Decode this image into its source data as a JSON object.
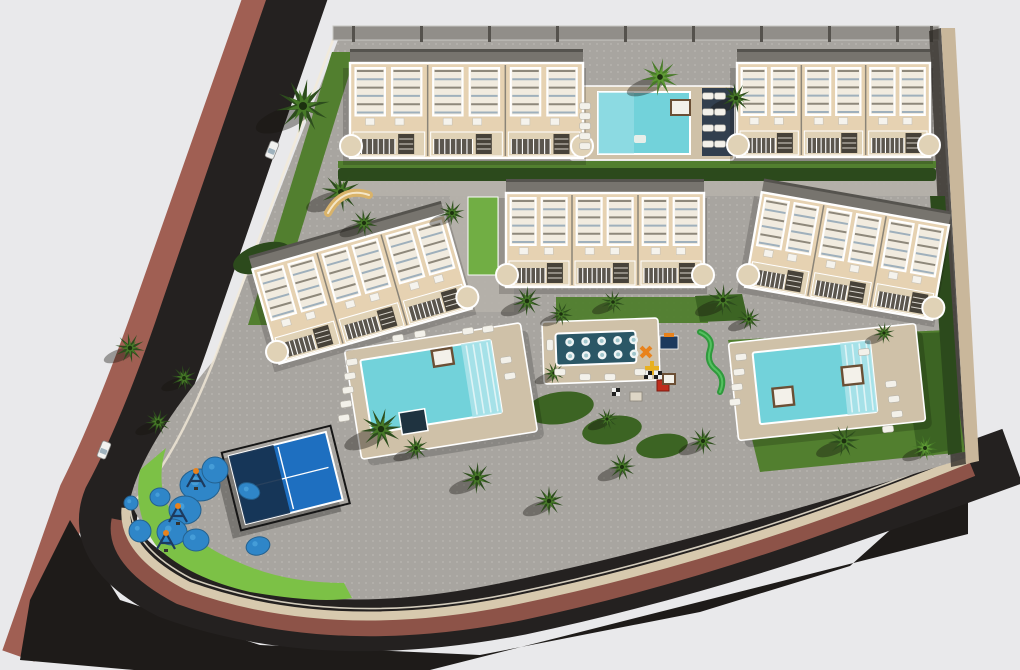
{
  "meta": {
    "description": "3D aerial architectural render of a coastal residential complex: five beige townhouse blocks with white rooftop pergolas, three turquoise swimming pools, a dark jet-spa platform, padel court, two playgrounds, palm trees and a curving asphalt road with terracotta sidewalks",
    "canvas_w": 1020,
    "canvas_h": 670
  },
  "palette": {
    "bg": "#e9e9eb",
    "road": "#242120",
    "shadow": "#1e1b19",
    "walk_outer": "#a05f53",
    "walk_inner": "#8d5348",
    "curb": "#d7c9ae",
    "curbline": "#f2ead8",
    "parcel": "#a8a5a0",
    "parcel_dot": "#c7c4be",
    "walk_light": "#b5b1aa",
    "wall_top": "#918e89",
    "wall_post": "#55524d",
    "wall_right": "#c9b79b",
    "wall_right_shadow": "#2f2b26",
    "grass_mid": "#527f2f",
    "grass_dark": "#3c6423",
    "grass_bright": "#6fae41",
    "crescent": "#7cc146",
    "hedge": "#2c4a1c",
    "palm_dark": "#2d4d1d",
    "palm_mid": "#477a28",
    "palm_light": "#5f9a35",
    "deck": "#cfc1a8",
    "pool": "#72d2da",
    "pool_light": "#aee4ea",
    "pool_step": "#dff4f6",
    "navy_deck": "#323f4e",
    "spa_pool": "#2b5766",
    "facade": "#e6d2b2",
    "facade_line": "#8a8478",
    "roof": "#77746e",
    "roof_edge": "#55534e",
    "balc_dark": "#5b564e",
    "stair": "#474239",
    "white": "#ffffff",
    "louver": "#9fb0bc",
    "louver2": "#8e887b",
    "tub": "#1f3340",
    "daybed": "#6b4f35",
    "lounger": "#f3f1ea",
    "padel_court": "#1e6fc0",
    "padel_canopy": "#16314f",
    "frame": "#161616",
    "pad_blue": "#2f86c8",
    "pad_blue2": "#4ba3dc",
    "equip_navy": "#1d3a5e",
    "orange": "#e8821c",
    "red": "#bf2c1c",
    "yellow": "#e8b020",
    "green_slide": "#2f9a3c",
    "tan": "#d9b36a",
    "shadow_soft": "rgba(20,18,14,0.38)"
  },
  "roads": {
    "road_d": "M 307,-30 L 190,310 Q 150,430 112,500 Q 92,550 170,590 Q 320,645 520,606 C 700,568 850,515 985,466",
    "road_w": 58,
    "outer_d": "M 270,-30 L 154,300 Q 112,420 76,492 L 24,640",
    "outer_w": 34,
    "shadow_pts": "70,520 120,600 260,645 480,655 700,612 850,566 968,460 968,534 430,670 134,670 20,660 30,600",
    "inner_d": "M 120,520 Q 112,560 180,596 Q 330,650 520,612 C 700,574 848,518 972,468",
    "inner_w": 17,
    "curb_d": "M 126,508 Q 122,552 188,586 Q 332,638 516,600 C 695,563 845,509 968,459",
    "curb_w": 9,
    "curbline_d": "M 130,500 Q 128,546 192,579 Q 334,630 514,593 C 692,556 843,503 966,452",
    "leftcurb_d": "M 336,32 L 214,360 Q 170,470 130,505"
  },
  "parcel": {
    "d": "M 338,40 L 938,40 L 966,458 C 830,500 640,556 486,586 Q 340,614 236,584 Q 150,556 130,500 Q 142,446 214,360 Z"
  },
  "walkways": [
    [
      338,
      181,
      600,
      15
    ],
    [
      450,
      182,
      64,
      130
    ]
  ],
  "walls": {
    "top": {
      "x": 333,
      "y": 26,
      "w": 606,
      "h": 14,
      "posts": [
        352,
        420,
        488,
        556,
        624,
        692,
        760,
        828,
        896,
        930
      ]
    },
    "right_lit": "941,28 955,28 979,461 966,464",
    "right_shadow": "929,31 941,28 966,464 951,467"
  },
  "grass": {
    "strip_light": [
      338,
      161,
      598,
      7
    ],
    "hedge_row": [
      338,
      168,
      598,
      13
    ],
    "rects": [
      [
        468,
        197,
        30,
        78,
        "bright"
      ],
      [
        556,
        297,
        152,
        26,
        "mid"
      ]
    ],
    "polys": [
      [
        "728,340 948,330 965,452 760,472",
        "mid"
      ],
      [
        "900,334 948,332 962,448 918,456",
        "dark"
      ],
      [
        "695,296 742,294 748,320 700,322",
        "dark"
      ],
      [
        "930,196 945,196 962,452 948,455",
        "hedge"
      ]
    ],
    "blobs": [
      [
        262,
        258,
        30,
        14,
        -18,
        "hedge"
      ],
      [
        560,
        408,
        34,
        16,
        -8,
        "dark"
      ],
      [
        612,
        430,
        30,
        14,
        -8,
        "dark"
      ],
      [
        662,
        446,
        26,
        12,
        -8,
        "dark"
      ]
    ],
    "verge": "332,52 356,52 272,325 248,325",
    "crescent": "M 140,470 Q 132,515 158,548 Q 190,578 250,592 Q 320,604 352,598 L 344,583 Q 284,583 238,562 Q 184,540 164,498 Q 158,472 166,448 Z"
  },
  "pools": {
    "north": {
      "deck": [
        570,
        86,
        164,
        74
      ],
      "pool": [
        598,
        92,
        92,
        62
      ],
      "navy": [
        702,
        88,
        32,
        68
      ],
      "daybed": [
        671,
        100,
        19,
        15
      ],
      "float": [
        634,
        135,
        12,
        8
      ]
    },
    "west": {
      "rot": -9,
      "cx": 441,
      "cy": 391,
      "deck": [
        352,
        336,
        178,
        110
      ],
      "pool": [
        366,
        348,
        132,
        74
      ],
      "steps": [
        468,
        348,
        30,
        74
      ],
      "tub": [
        396,
        406,
        26,
        22
      ],
      "daybed": [
        438,
        350,
        20,
        16
      ]
    },
    "east": {
      "rot": -6,
      "cx": 827,
      "cy": 382,
      "deck": [
        733,
        333,
        188,
        98
      ],
      "pool": [
        756,
        345,
        118,
        72
      ],
      "steps": [
        844,
        345,
        30,
        72
      ],
      "daybeds": [
        [
          772,
          383,
          20,
          18
        ],
        [
          843,
          369,
          20,
          18
        ]
      ]
    },
    "spa": {
      "rot": -2,
      "cx": 601,
      "cy": 351,
      "platform": [
        543,
        320,
        116,
        62
      ],
      "pool": [
        556,
        332,
        80,
        32
      ],
      "jet_rows": [
        341,
        355
      ],
      "jet_x0": 570,
      "jet_dx": 16,
      "jet_n": 5
    }
  },
  "buildings": [
    {
      "id": "a",
      "x": 350,
      "y": 63,
      "w": 233,
      "h": 95,
      "rot": 0,
      "units": 3
    },
    {
      "id": "b",
      "x": 737,
      "y": 63,
      "w": 193,
      "h": 94,
      "rot": 0,
      "units": 3
    },
    {
      "id": "c",
      "x": 506,
      "y": 193,
      "w": 198,
      "h": 94,
      "rot": 0,
      "units": 3
    },
    {
      "id": "d",
      "x": 752,
      "y": 208,
      "w": 190,
      "h": 96,
      "rot": 10,
      "units": 3
    },
    {
      "id": "e",
      "x": 262,
      "y": 240,
      "w": 200,
      "h": 98,
      "rot": -16,
      "units": 3
    }
  ],
  "palms": [
    [
      303,
      106,
      27,
      0
    ],
    [
      341,
      192,
      20,
      0
    ],
    [
      364,
      223,
      14,
      0
    ],
    [
      452,
      213,
      13,
      0
    ],
    [
      660,
      77,
      19,
      1
    ],
    [
      736,
      98,
      15,
      0
    ],
    [
      527,
      301,
      15,
      0
    ],
    [
      561,
      314,
      12,
      0
    ],
    [
      613,
      302,
      12,
      0
    ],
    [
      723,
      300,
      16,
      0
    ],
    [
      749,
      319,
      12,
      0
    ],
    [
      130,
      348,
      15,
      0
    ],
    [
      184,
      378,
      13,
      0
    ],
    [
      158,
      422,
      13,
      0
    ],
    [
      381,
      429,
      21,
      0
    ],
    [
      416,
      448,
      13,
      0
    ],
    [
      477,
      478,
      16,
      0
    ],
    [
      549,
      501,
      15,
      0
    ],
    [
      622,
      467,
      14,
      0
    ],
    [
      703,
      441,
      14,
      0
    ],
    [
      844,
      441,
      16,
      0
    ],
    [
      925,
      448,
      13,
      1
    ],
    [
      884,
      333,
      11,
      0
    ],
    [
      554,
      373,
      11,
      0
    ],
    [
      607,
      419,
      11,
      0
    ]
  ],
  "loungers": [
    [
      585,
      106,
      0
    ],
    [
      585,
      116,
      0
    ],
    [
      585,
      126,
      0
    ],
    [
      585,
      136,
      0
    ],
    [
      585,
      146,
      0
    ],
    [
      708,
      96,
      0
    ],
    [
      720,
      96,
      0
    ],
    [
      708,
      112,
      0
    ],
    [
      720,
      112,
      0
    ],
    [
      708,
      128,
      0
    ],
    [
      720,
      128,
      0
    ],
    [
      708,
      144,
      0
    ],
    [
      720,
      144,
      0
    ],
    [
      352,
      362,
      -9
    ],
    [
      350,
      376,
      -9
    ],
    [
      348,
      390,
      -9
    ],
    [
      346,
      404,
      -9
    ],
    [
      344,
      418,
      -9
    ],
    [
      398,
      338,
      -9
    ],
    [
      420,
      334,
      -9
    ],
    [
      468,
      331,
      -9
    ],
    [
      488,
      329,
      -9
    ],
    [
      506,
      360,
      -9
    ],
    [
      510,
      376,
      -9
    ],
    [
      741,
      357,
      -6
    ],
    [
      739,
      372,
      -6
    ],
    [
      737,
      387,
      -6
    ],
    [
      735,
      402,
      -6
    ],
    [
      891,
      384,
      -6
    ],
    [
      894,
      399,
      -6
    ],
    [
      897,
      414,
      -6
    ],
    [
      888,
      429,
      -6
    ],
    [
      864,
      352,
      -6
    ],
    [
      550,
      345,
      90
    ],
    [
      560,
      372,
      0
    ],
    [
      585,
      377,
      0
    ],
    [
      610,
      377,
      0
    ],
    [
      640,
      372,
      0
    ]
  ],
  "cars": [
    [
      272,
      150,
      -68
    ],
    [
      104,
      450,
      -68
    ]
  ],
  "padel": {
    "rot": -14,
    "cx": 286,
    "cy": 479,
    "frame": [
      230,
      438,
      112,
      80
    ],
    "court": [
      236,
      443,
      100,
      70
    ],
    "canopy": [
      236,
      443,
      46,
      70
    ]
  },
  "pg1": {
    "pads": [
      [
        200,
        485,
        20,
        16,
        0
      ],
      [
        185,
        510,
        16,
        14,
        0
      ],
      [
        172,
        532,
        15,
        13,
        0
      ],
      [
        196,
        540,
        13,
        11,
        0
      ],
      [
        215,
        470,
        13,
        13,
        0
      ],
      [
        249,
        491,
        11,
        8,
        20
      ],
      [
        140,
        531,
        11,
        11,
        0
      ],
      [
        131,
        503,
        7,
        7,
        0
      ],
      [
        258,
        546,
        12,
        9,
        -15
      ],
      [
        160,
        497,
        10,
        9,
        0
      ]
    ],
    "equip": [
      [
        196,
        480
      ],
      [
        178,
        515
      ],
      [
        166,
        542
      ]
    ]
  },
  "pg2": {
    "navy_box": [
      660,
      336,
      18,
      13
    ],
    "cross": [
      646,
      352
    ],
    "bars": [
      652,
      368
    ],
    "red_box": [
      657,
      380,
      12,
      11
    ],
    "table": [
      630,
      392,
      12,
      9
    ],
    "slide_d": "M 700,332 q 14,6 10,18 q -4,12 6,20 q 10,8 4,22",
    "checker": [
      612,
      388
    ],
    "spa_checker": [
      644,
      371
    ],
    "spa_table": [
      663,
      374,
      12,
      10
    ]
  },
  "misc": {
    "tan_arc": "M 328,213 Q 343,186 369,195"
  }
}
